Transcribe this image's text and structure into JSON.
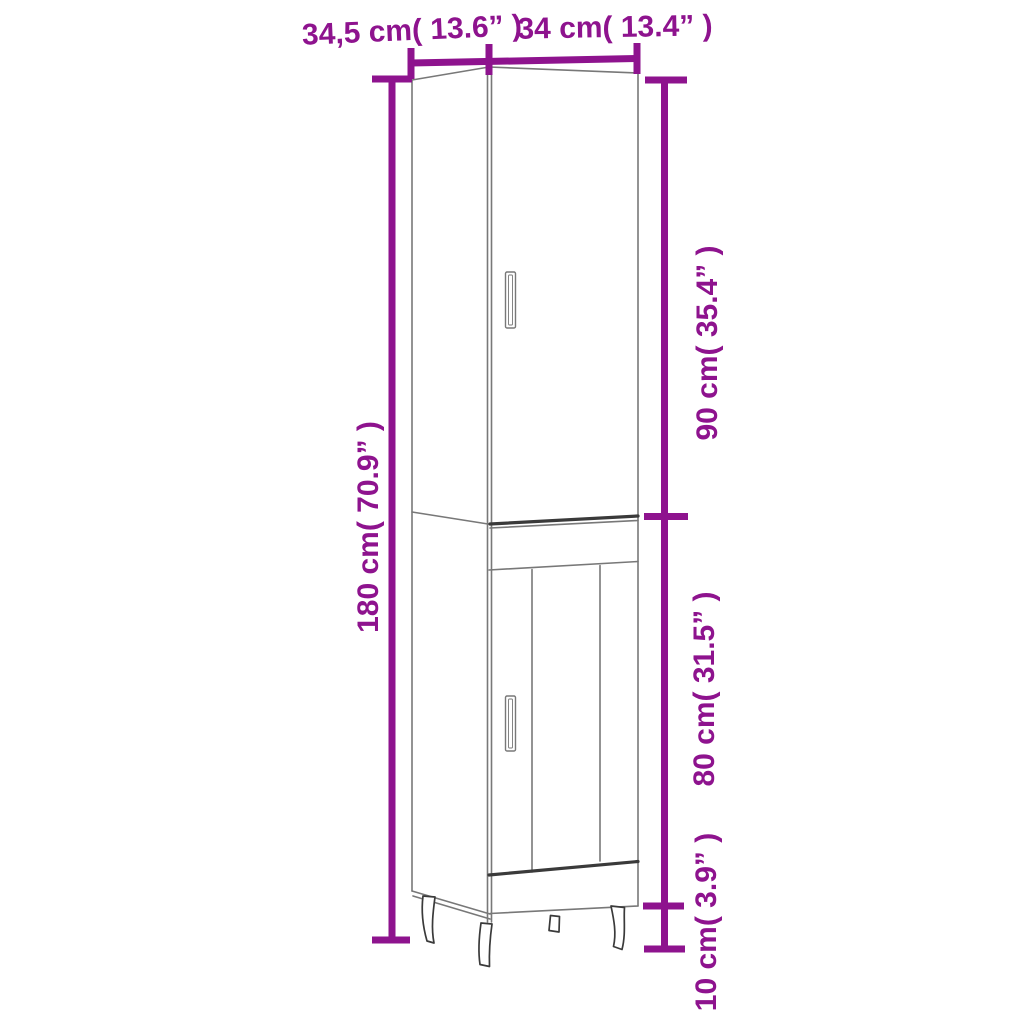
{
  "figure": {
    "type": "product-dimension-diagram",
    "subject": "tall narrow highboard cabinet with two doors and metal legs",
    "background": "#ffffff"
  },
  "colors": {
    "dimension_annotation": "#8e138e",
    "drawing_outline": "#787878",
    "drawing_outline_dark": "#3a3a3a"
  },
  "dimensions": {
    "top_left": {
      "label": "34,5 cm( 13.6” )",
      "value_cm": 34.5,
      "value_in": 13.6
    },
    "top_right": {
      "label": "34 cm( 13.4” )",
      "value_cm": 34,
      "value_in": 13.4
    },
    "left_side": {
      "label": "180 cm( 70.9” )",
      "value_cm": 180,
      "value_in": 70.9
    },
    "right_upper": {
      "label": "90 cm( 35.4” )",
      "value_cm": 90,
      "value_in": 35.4
    },
    "right_middle": {
      "label": "80 cm( 31.5” )",
      "value_cm": 80,
      "value_in": 31.5
    },
    "right_lower": {
      "label": "10 cm( 3.9” )",
      "value_cm": 10,
      "value_in": 3.9
    }
  }
}
